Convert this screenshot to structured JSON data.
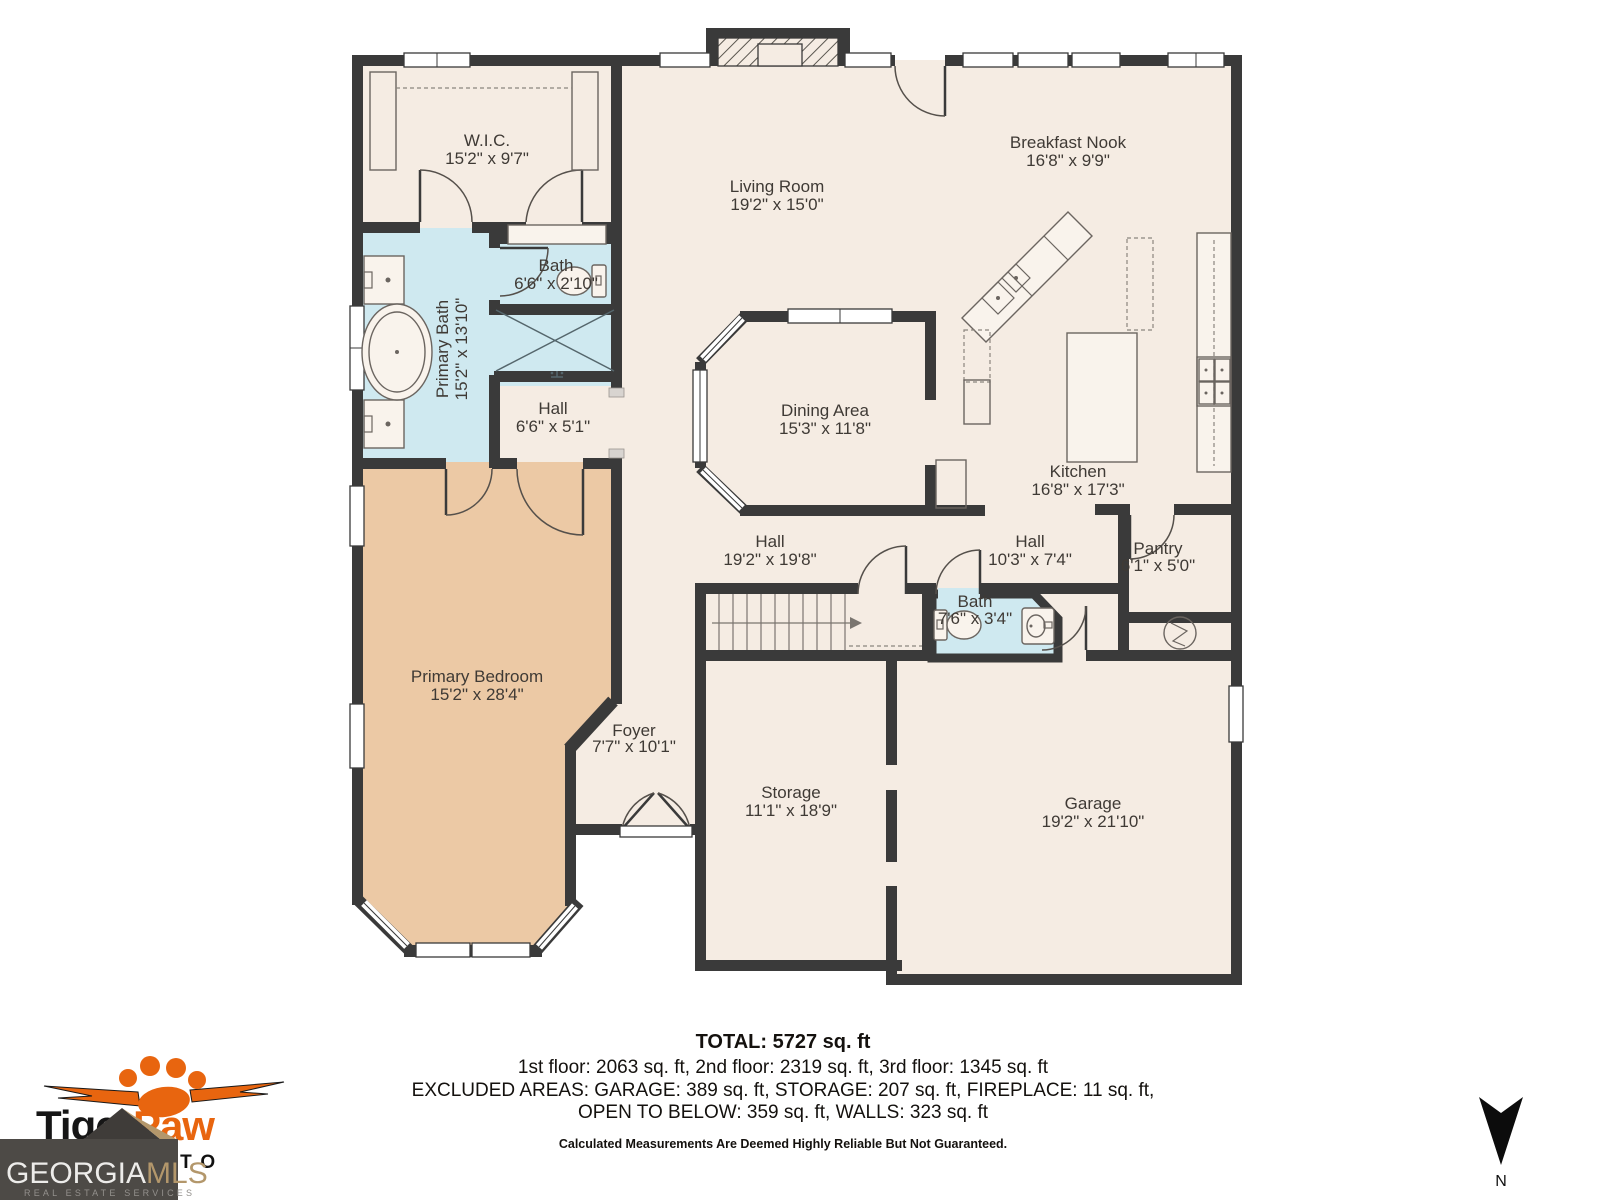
{
  "colors": {
    "wall": "#3a3a3a",
    "floor": "#f5ece3",
    "wet_room": "#cfe9f0",
    "bedroom": "#ecc9a5",
    "logo_orange": "#e8650f",
    "mls_box": "#4d4a46",
    "mls_gold": "#b3976b"
  },
  "rooms": [
    {
      "name": "W.I.C.",
      "dims": "15'2\" x 9'7\""
    },
    {
      "name": "Living Room",
      "dims": "19'2\" x 15'0\""
    },
    {
      "name": "Breakfast Nook",
      "dims": "16'8\" x 9'9\""
    },
    {
      "name": "Bath",
      "dims": "6'6\" x 2'10\""
    },
    {
      "name": "Primary Bath",
      "dims": "15'2\" x 13'10\""
    },
    {
      "name": "Hall",
      "dims": "6'6\" x 5'1\""
    },
    {
      "name": "Dining Area",
      "dims": "15'3\" x 11'8\""
    },
    {
      "name": "Kitchen",
      "dims": "16'8\" x 17'3\""
    },
    {
      "name": "Hall",
      "dims": "19'2\" x 19'8\""
    },
    {
      "name": "Hall",
      "dims": "10'3\" x 7'4\""
    },
    {
      "name": "Pantry",
      "dims": "6'1\" x 5'0\""
    },
    {
      "name": "Bath",
      "dims": "7'6\" x 3'4\""
    },
    {
      "name": "Primary Bedroom",
      "dims": "15'2\" x 28'4\""
    },
    {
      "name": "Foyer",
      "dims": "7'7\" x 10'1\""
    },
    {
      "name": "Storage",
      "dims": "11'1\" x 18'9\""
    },
    {
      "name": "Garage",
      "dims": "19'2\" x 21'10\""
    }
  ],
  "summary": {
    "total": "TOTAL: 5727 sq. ft",
    "floors": "1st floor: 2063 sq. ft, 2nd floor: 2319 sq. ft, 3rd floor: 1345 sq. ft",
    "excluded1": "EXCLUDED AREAS: GARAGE: 389 sq. ft, STORAGE: 207 sq. ft, FIREPLACE: 11 sq. ft,",
    "excluded2": "OPEN TO BELOW: 359 sq. ft, WALLS: 323 sq. ft",
    "disclaimer": "Calculated Measurements Are Deemed Highly Reliable But Not Guaranteed."
  },
  "branding": {
    "tiger": "Tiger",
    "paw": "Paw",
    "photo": "PHOTO",
    "georgia": "GEORGIA",
    "mls": "MLS",
    "mls_sub": "REAL ESTATE SERVICES"
  },
  "compass": {
    "label": "N"
  }
}
